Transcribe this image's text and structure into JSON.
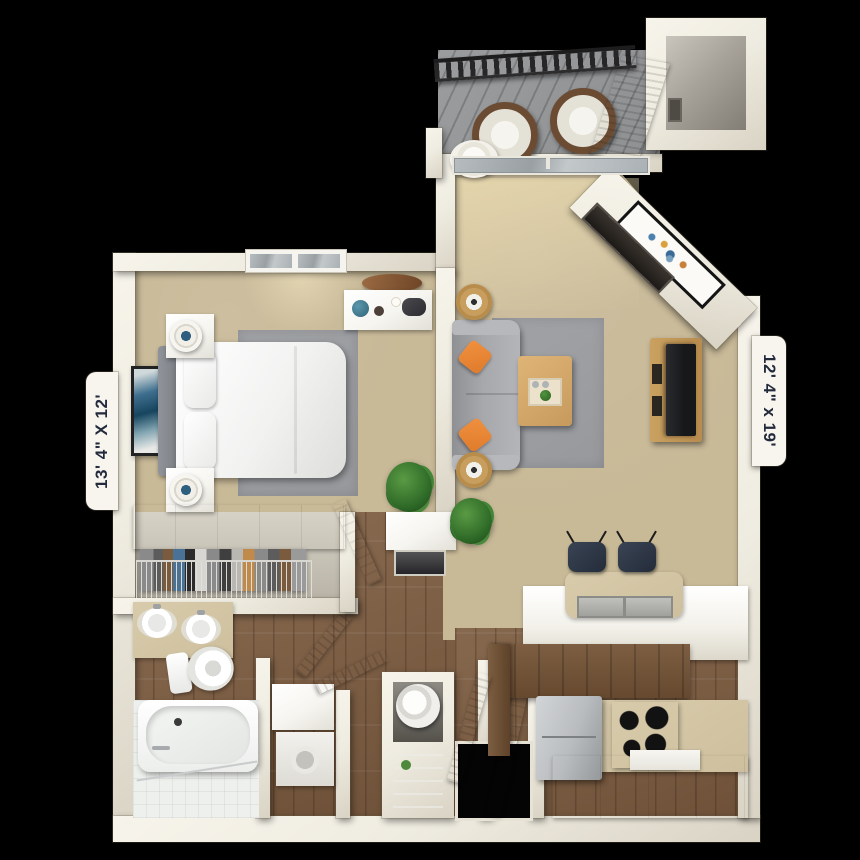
{
  "dimension_labels": {
    "bedroom": "13' 4\" X 12'",
    "living_room": "12' 4\" x 19'"
  },
  "colors": {
    "background": "#000000",
    "wall": "#efece1",
    "wall_shade": "#d9d3c4",
    "carpet": "#c8b997",
    "carpet_light": "#e6d8ae",
    "wood": "#86684e",
    "wood_dark": "#6e5138",
    "balcony_floor": "#8e9092",
    "railing": "#262626",
    "rug": "#97999d",
    "sofa": "#a7a8ac",
    "accent_orange": "#df7b2b",
    "counter_tan": "#cec09e",
    "furniture_white": "#f6f5f0",
    "appliance_gray": "#b9bcbe",
    "tv_black": "#17181a",
    "plant_green": "#3c7d33",
    "glass": "#aab1b5",
    "label_ink": "#232a3c",
    "label_bg": "#f7f5ee"
  }
}
